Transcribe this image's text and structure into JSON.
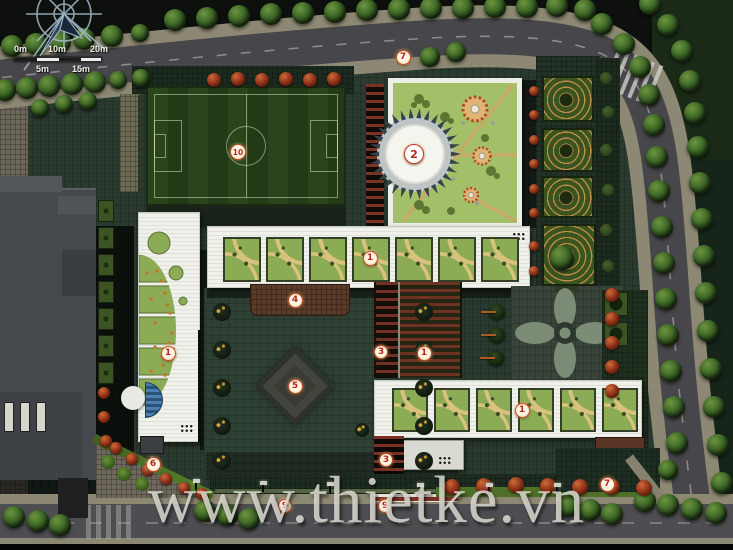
{
  "watermark": {
    "text": "www.thietke.vn"
  },
  "scale_bar": {
    "labels_top": [
      "0m",
      "10m",
      "20m"
    ],
    "labels_bottom": [
      "5m",
      "15m"
    ]
  },
  "markers": [
    {
      "label": "7",
      "x": 403,
      "y": 57,
      "size": 15
    },
    {
      "label": "2",
      "x": 414,
      "y": 154,
      "size": 20
    },
    {
      "label": "10",
      "x": 238,
      "y": 152,
      "size": 16
    },
    {
      "label": "1",
      "x": 370,
      "y": 258,
      "size": 15
    },
    {
      "label": "4",
      "x": 295,
      "y": 300,
      "size": 15
    },
    {
      "label": "3",
      "x": 381,
      "y": 352,
      "size": 14
    },
    {
      "label": "1",
      "x": 424,
      "y": 353,
      "size": 15
    },
    {
      "label": "5",
      "x": 295,
      "y": 386,
      "size": 15
    },
    {
      "label": "1",
      "x": 168,
      "y": 353,
      "size": 15
    },
    {
      "label": "1",
      "x": 522,
      "y": 410,
      "size": 15
    },
    {
      "label": "6",
      "x": 153,
      "y": 464,
      "size": 15
    },
    {
      "label": "3",
      "x": 386,
      "y": 460,
      "size": 14
    },
    {
      "label": "9",
      "x": 285,
      "y": 506,
      "size": 14
    },
    {
      "label": "9",
      "x": 385,
      "y": 506,
      "size": 14
    },
    {
      "label": "7",
      "x": 607,
      "y": 484,
      "size": 15
    }
  ],
  "palette": {
    "site_green": "#2b3a2f",
    "road_asphalt": "#47474b",
    "sidewalk_tan": "#8d8873",
    "building_white": "#f0f1ea",
    "module_green": "#8cab55",
    "lawn_green": "#a3c068",
    "canopy_brown": "#5a3a29",
    "tree_green": "#3c6626",
    "tree_red": "#8c3018",
    "water_blue": "#4d80b0",
    "marker_red": "#b5271d"
  }
}
